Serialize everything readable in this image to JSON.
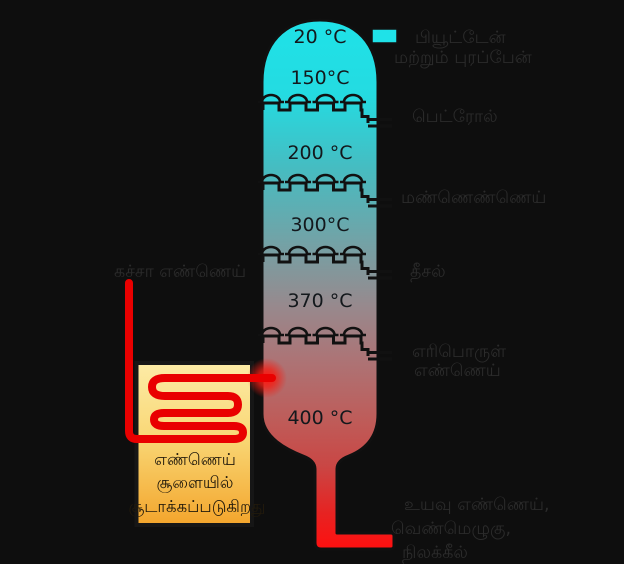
{
  "diagram": {
    "kind": "fractional-distillation-column",
    "background_color": "#0e0e0e"
  },
  "column": {
    "temps": [
      "20 °C",
      "150°C",
      "200 °C",
      "300°C",
      "370 °C",
      "400 °C"
    ],
    "top_color": "#1fe2e8",
    "bottom_color": "#ff0f0f",
    "outline_color": "#101010",
    "tray_count": 4,
    "caps_per_tray": 4
  },
  "products": {
    "top_lines": [
      "பியூட்டேன்",
      "மற்றும் புரப்பேன்"
    ],
    "petrol": "பெட்ரோல்",
    "kerosene": "மண்ணெண்ணெய்",
    "diesel": "தீசல்",
    "fuel_oil_lines": [
      "எரிபொருள்",
      "எண்ணெய்"
    ],
    "residue_lines": [
      "உயவு எண்ணெய்,",
      "வெண்மெழுகு,",
      "நிலக்கீல்"
    ]
  },
  "feed": {
    "crude_oil": "கச்சா எண்ணெய்",
    "pipe_color": "#e90000"
  },
  "furnace": {
    "lines": [
      "எண்ணெய்",
      "சூளையில்",
      "சூடாக்கப்படுகிறது"
    ],
    "top_color": "#fceba6",
    "bottom_color": "#f3a52c",
    "border_color": "#161616"
  },
  "label_color": "#2b2b2b"
}
